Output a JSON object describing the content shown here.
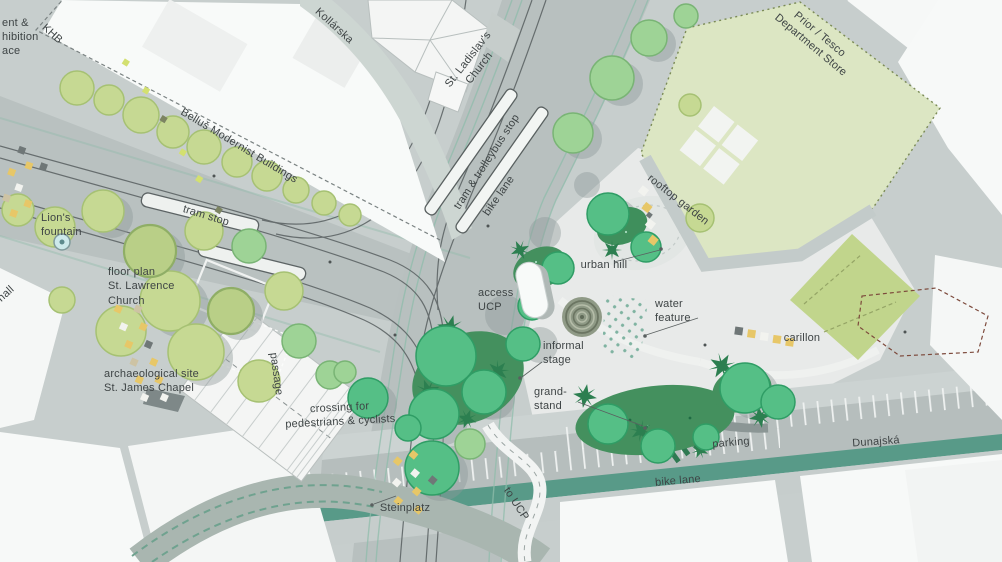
{
  "labels": {
    "frag_line1": "ent &",
    "frag_line2": "hibition",
    "frag_line3": "ace",
    "hall_frag": "hall",
    "khb": "KHB",
    "bellus": "Belluš Modernist Buildings",
    "kollarska": "Kollárska",
    "ladislav": "St. Ladislav's\nChurch",
    "tram_trolleybus": "tram & trolleybus stop",
    "bike_lane_top": "bike lane",
    "tram_stop": "tram stop",
    "lions_fountain": "Lion's\nfountain",
    "floor_plan": "floor plan\nSt. Lawrence\nChurch",
    "arch_site": "archaeological site\nSt. James Chapel",
    "passage": "passage",
    "crossing": "crossing for\npedestrians & cyclists",
    "access_ucp": "access\nUCP",
    "urban_hill": "urban hill",
    "water_feature": "water\nfeature",
    "informal_stage": "informal\nstage",
    "grand_stand": "grand-\nstand",
    "steinplatz": "Steinplatz",
    "to_ucp": "to UCP",
    "parking": "parking",
    "dunajska": "Dunajská",
    "bike_lane_bottom": "bike lane",
    "carillon": "carillon",
    "rooftop_garden": "rooftop garden",
    "prior_tesco": "Prior / Tesco\nDepartment Store"
  },
  "palette": {
    "pavement": "#c7cecd",
    "road": "#b8c0bf",
    "plaza": "#e8eae9",
    "building_white": "#f7f9f8",
    "rooftop_garden_green": "#dce6c3",
    "green_roof_square": "#c1d58c",
    "tree_light": "#c6d993",
    "tree_mid": "#9ed396",
    "tree_bright": "#55bf86",
    "shrub_dark": "#44905e",
    "bike_lane_teal": "#589a88",
    "tram_track": "#585f60",
    "bench_yellow": "#e7c768",
    "fountain_blue": "#cde9ea",
    "label_text": "#3e4445",
    "red_dashed_outline": "#7d4a3c"
  }
}
